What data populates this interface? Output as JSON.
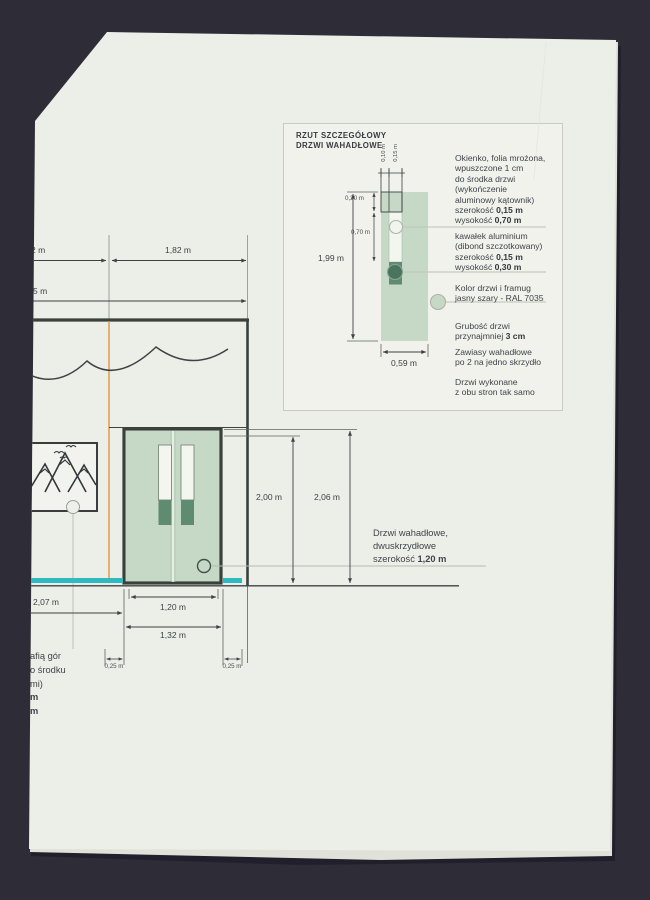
{
  "colors": {
    "background": "#2e2c37",
    "paper": "#ecefe8",
    "door_green": "#c5d9c6",
    "aluminium_green": "#5f8b71",
    "floor_teal": "#2fb9c0",
    "axis_orange": "#d8953f",
    "line_dark": "#3e4245"
  },
  "detail_panel": {
    "title_line1": "RZUT SZCZEGÓŁOWY",
    "title_line2": "DRZWI WAHADŁOWE",
    "dims": {
      "height": "1,99 m",
      "width": "0,59 m",
      "top_offset": "0,20 m",
      "window_height": "0,70 m",
      "edge_offset": "0,10 m",
      "window_width": "0,15 m"
    },
    "annotations": [
      {
        "lines": [
          {
            "t": "Okienko, folia mrożona,",
            "b": ""
          },
          {
            "t": "wpuszczone 1 cm",
            "b": ""
          },
          {
            "t": "do środka drzwi",
            "b": ""
          },
          {
            "t": "(wykończenie",
            "b": ""
          },
          {
            "t": "aluminowy kątownik)",
            "b": ""
          },
          {
            "t": "szerokość ",
            "b": "0,15 m"
          },
          {
            "t": "wysokość ",
            "b": "0,70 m"
          }
        ]
      },
      {
        "lines": [
          {
            "t": "kawałek aluminium",
            "b": ""
          },
          {
            "t": "(dibond szczotkowany)",
            "b": ""
          },
          {
            "t": "szerokość ",
            "b": "0,15 m"
          },
          {
            "t": "wysokość ",
            "b": "0,30 m"
          }
        ]
      },
      {
        "lines": [
          {
            "t": "Kolor drzwi i framug",
            "b": ""
          },
          {
            "t": "jasny szary - RAL 7035",
            "b": ""
          }
        ]
      },
      {
        "lines": [
          {
            "t": "Grubość drzwi",
            "b": ""
          },
          {
            "t": "przynajmniej ",
            "b": "3 cm"
          }
        ]
      },
      {
        "lines": [
          {
            "t": "Zawiasy wahadłowe",
            "b": ""
          },
          {
            "t": "po 2 na jedno skrzydło",
            "b": ""
          }
        ]
      },
      {
        "lines": [
          {
            "t": "Drzwi wykonane",
            "b": ""
          },
          {
            "t": "z obu stron tak samo",
            "b": ""
          }
        ]
      }
    ]
  },
  "main_drawing": {
    "dims": {
      "top_left_partial": "2 m",
      "top_right": "1,82 m",
      "total_partial": "5 m",
      "door_height": "2,00 m",
      "frame_height": "2,06 m",
      "left_span": "2,07 m",
      "clear_width": "1,20 m",
      "frame_width": "1,32 m",
      "offset_left": "0,25 m",
      "offset_right": "0,25 m"
    },
    "door_label": {
      "line1": "Drzwi wahadłowe,",
      "line2": "dwuskrzydłowe",
      "line3": "szerokość ",
      "line3_bold": "1,20 m"
    },
    "sign_caption": {
      "line1": "afią gór",
      "line2": "o środku",
      "line3": "mi)",
      "line4": "m",
      "line5": "m"
    }
  }
}
